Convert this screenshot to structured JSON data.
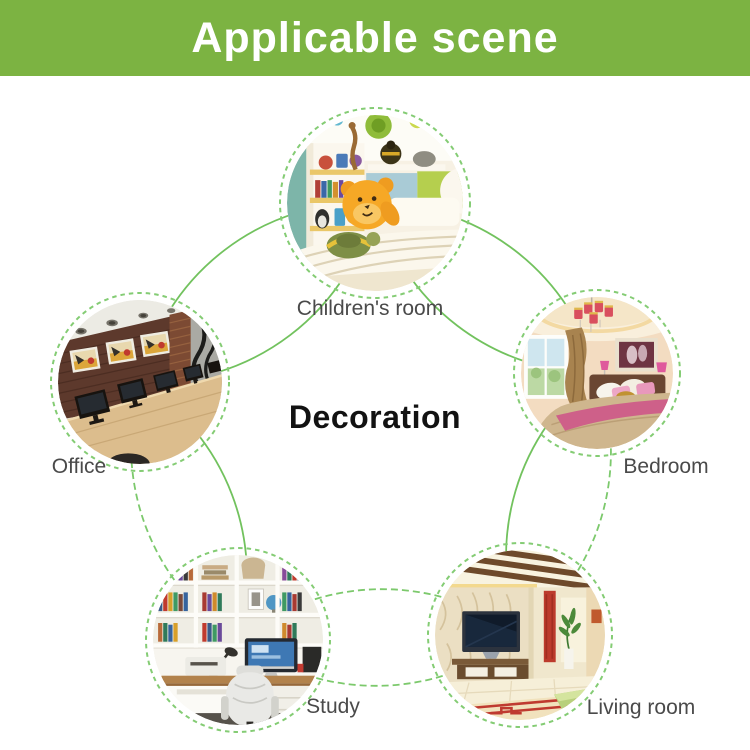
{
  "header": {
    "title": "Applicable scene",
    "bg_color": "#7cb342",
    "text_color": "#ffffff"
  },
  "center": {
    "label": "Decoration",
    "text_color": "#121212"
  },
  "diagram": {
    "solid_line_color": "#72c25e",
    "dashed_line_color": "#7cc96c",
    "ring_color": "#84cc74",
    "label_color": "#4a4a4a",
    "scenes": [
      {
        "id": "children-room",
        "label": "Children's room"
      },
      {
        "id": "bedroom",
        "label": "Bedroom"
      },
      {
        "id": "living-room",
        "label": "Living room"
      },
      {
        "id": "study",
        "label": "Study"
      },
      {
        "id": "office",
        "label": "Office"
      }
    ]
  }
}
